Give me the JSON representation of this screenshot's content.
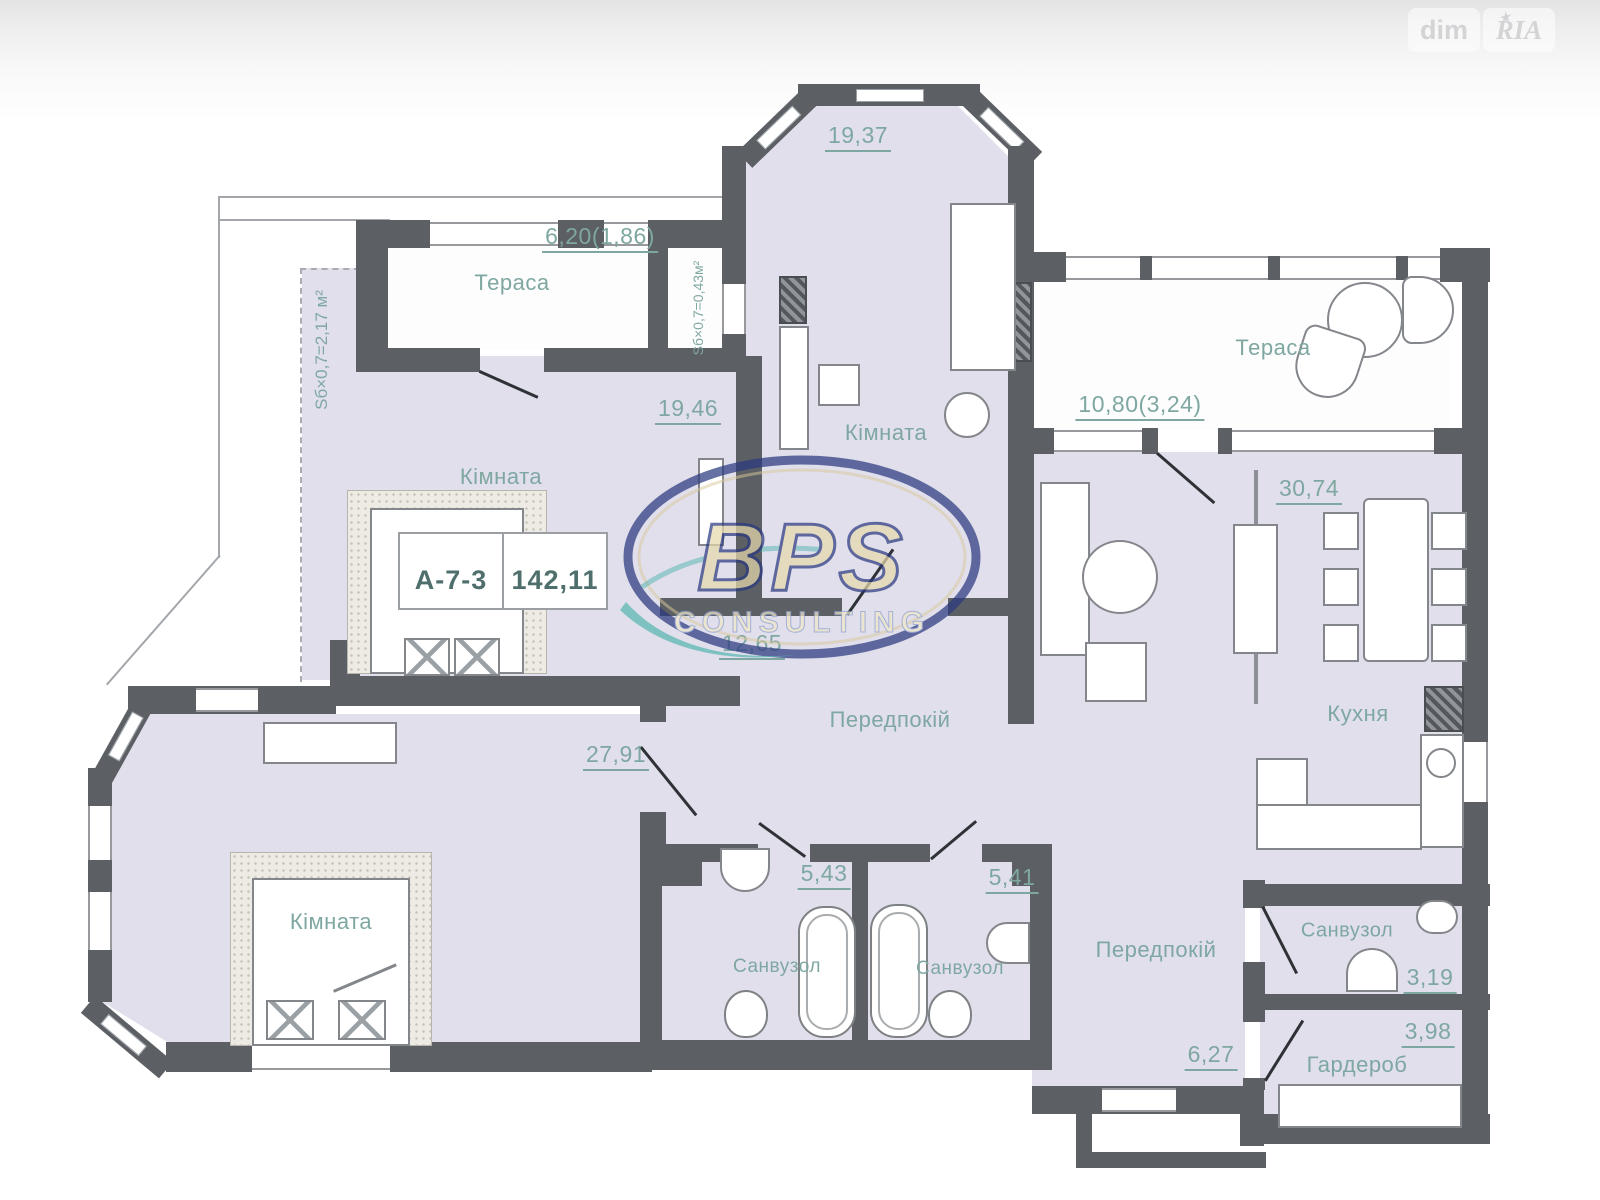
{
  "watermark": {
    "left": "dim",
    "right": "RIA",
    "star": "★"
  },
  "logo": {
    "name": "BPS",
    "sub": "CONSULTING"
  },
  "unit": {
    "code": "А-7-3",
    "total_area": "142,11"
  },
  "labels": {
    "terrace1": {
      "name": "Тераса",
      "area": "6,20(1,86)"
    },
    "shaft": {
      "area_note": "Sб×0,7=0,43м²"
    },
    "niche": {
      "area_note": "Sб×0,7=2,17 м²"
    },
    "room_1946": {
      "name": "Кімната",
      "area": "19,46"
    },
    "room_1937": {
      "name": "Кімната",
      "area": "19,37"
    },
    "terrace2": {
      "name": "Тераса",
      "area": "10,80(3,24)"
    },
    "kitchen": {
      "name": "Кухня",
      "area": "30,74"
    },
    "hall1": {
      "name": "Передпокій",
      "area": "12,65"
    },
    "room_2791": {
      "name": "Кімната",
      "area": "27,91"
    },
    "bath1": {
      "name": "Санвузол",
      "area": "5,43"
    },
    "bath2": {
      "name": "Санвузол",
      "area": "5,41"
    },
    "hall2": {
      "name": "Передпокій",
      "area": "6,27"
    },
    "bath3": {
      "name": "Санвузол",
      "area": "3,19"
    },
    "wardrobe": {
      "name": "Гардероб",
      "area": "3,98"
    }
  },
  "colors": {
    "wall": "#5c6064",
    "room_fill": "#e0dfeb",
    "label": "#7fa7a1",
    "logo_navy": "#2b3a80",
    "logo_gold": "#e6d9ac",
    "logo_teal": "#2aa79e"
  }
}
